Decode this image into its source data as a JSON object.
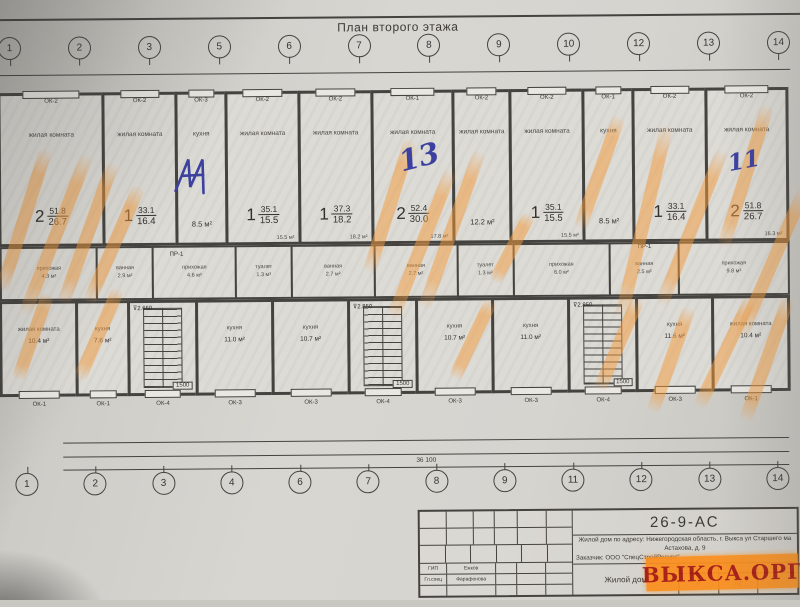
{
  "title": "План второго этажа",
  "watermark": "ВЫКСА.ОРГ",
  "colors": {
    "line": "#45433f",
    "wall": "#45433f",
    "highlight": "#f39a3a",
    "pen": "#3c41a0",
    "wm_bg": "#fb8f1d",
    "wm_text": "#a6160d"
  },
  "axes_top": [
    {
      "n": "1"
    },
    {
      "n": "2"
    },
    {
      "n": "3"
    },
    {
      "n": "5"
    },
    {
      "n": "6"
    },
    {
      "n": "7"
    },
    {
      "n": "8"
    },
    {
      "n": "9"
    },
    {
      "n": "10"
    },
    {
      "n": "12"
    },
    {
      "n": "13"
    },
    {
      "n": "14"
    }
  ],
  "axes_bottom": [
    {
      "n": "1"
    },
    {
      "n": "2"
    },
    {
      "n": "3"
    },
    {
      "n": "4"
    },
    {
      "n": "6"
    },
    {
      "n": "7"
    },
    {
      "n": "8"
    },
    {
      "n": "9"
    },
    {
      "n": "11"
    },
    {
      "n": "12"
    },
    {
      "n": "13"
    },
    {
      "n": "14"
    }
  ],
  "dims_top": [
    {
      "v": "400"
    },
    {
      "v": "2 100"
    },
    {
      "v": "1 250"
    },
    {
      "v": "2 100"
    },
    {
      "v": "1 500"
    },
    {
      "v": "1 200"
    },
    {
      "v": "1 750"
    },
    {
      "v": "2 100"
    },
    {
      "v": "1 050"
    },
    {
      "v": "2 100"
    },
    {
      "v": "1 625"
    },
    {
      "v": "1 500"
    },
    {
      "v": "1 625"
    },
    {
      "v": "2 100"
    },
    {
      "v": "1 050"
    },
    {
      "v": "2 100"
    },
    {
      "v": "750"
    },
    {
      "v": "1 200"
    },
    {
      "v": "1 500"
    },
    {
      "v": "2 100"
    },
    {
      "v": "1 250"
    },
    {
      "v": "2 100"
    },
    {
      "v": "400"
    }
  ],
  "dims_bottom1": [
    {
      "v": "765"
    },
    {
      "v": "1 500"
    },
    {
      "v": "1 800"
    },
    {
      "v": "1 200"
    },
    {
      "v": "2 000"
    },
    {
      "v": "1 000"
    },
    {
      "v": "2 000"
    },
    {
      "v": "1 200"
    },
    {
      "v": "2 760"
    },
    {
      "v": "1 200"
    },
    {
      "v": "2 000"
    },
    {
      "v": "1 000"
    },
    {
      "v": "2 000"
    },
    {
      "v": "1 200"
    },
    {
      "v": "2 760"
    },
    {
      "v": "1 200"
    },
    {
      "v": "2 000"
    },
    {
      "v": "1 000"
    },
    {
      "v": "2 000"
    },
    {
      "v": "1 200"
    },
    {
      "v": "1 800"
    },
    {
      "v": "1 500"
    },
    {
      "v": "765"
    }
  ],
  "dims_bottom2": [
    {
      "v": "3 250"
    },
    {
      "v": "3 200"
    },
    {
      "v": "2 680"
    },
    {
      "v": "3 680"
    },
    {
      "v": "3 600"
    },
    {
      "v": "2 880"
    },
    {
      "v": "3 600"
    },
    {
      "v": "3 680"
    },
    {
      "v": "2 880"
    },
    {
      "v": "3 200"
    },
    {
      "v": "3 250"
    }
  ],
  "dims_total": "36 100",
  "rooms_top": [
    {
      "window": "ОК-2",
      "label": "жилая комната",
      "num": "2",
      "a1": "51.8",
      "a2": "26.7"
    },
    {
      "window": "ОК-2",
      "label": "жилая комната",
      "num": "1",
      "a1": "33.1",
      "a2": "16.4"
    },
    {
      "window": "ОК-3",
      "label": "кухня",
      "note": "8.5 м²"
    },
    {
      "window": "ОК-2",
      "label": "жилая комната",
      "num": "1",
      "a1": "35.1",
      "a2": "15.5",
      "sub": "15.5 м²"
    },
    {
      "window": "ОК-2",
      "label": "жилая комната",
      "num": "1",
      "a1": "37.3",
      "a2": "18.2",
      "sub": "18.2 м²"
    },
    {
      "window": "ОК-1",
      "label": "жилая комната",
      "num": "2",
      "a1": "52.4",
      "a2": "30.0",
      "sub": "17.8 м²"
    },
    {
      "window": "ОК-2",
      "label": "жилая комната",
      "note": "12.2 м²"
    },
    {
      "window": "ОК-2",
      "label": "жилая комната",
      "num": "1",
      "a1": "35.1",
      "a2": "15.5",
      "sub": "15.5 м²"
    },
    {
      "window": "ОК-1",
      "label": "кухня",
      "note": "8.5 м²"
    },
    {
      "window": "ОК-2",
      "label": "жилая комната",
      "num": "1",
      "a1": "33.1",
      "a2": "16.4"
    },
    {
      "window": "ОК-2",
      "label": "жилая комната",
      "num": "2",
      "a1": "51.8",
      "a2": "26.7",
      "sub": "16.3 м²"
    }
  ],
  "service": [
    {
      "label": "прихожая",
      "area": "4.3 м²"
    },
    {
      "label": "ванная",
      "area": "2.9 м²"
    },
    {
      "label": "прихожая",
      "area": "4.6 м²"
    },
    {
      "label": "туалет",
      "area": "1.3 м²"
    },
    {
      "label": "ванная",
      "area": "2.7 м²"
    },
    {
      "label": "ванная",
      "area": "2.7 м²"
    },
    {
      "label": "туалет",
      "area": "1.3 м²"
    },
    {
      "label": "прихожая",
      "area": "6.0 м²"
    },
    {
      "label": "ванная",
      "area": "2.5 м²"
    },
    {
      "label": "прихожая",
      "area": "9.8 м²"
    }
  ],
  "rooms_bottom": [
    {
      "label": "жилая комната",
      "area": "10.4 м²",
      "window": "ОК-1"
    },
    {
      "label": "кухня",
      "area": "7.6 м²",
      "window": "ОК-1"
    },
    {
      "stairs": true,
      "window": "ОК-4",
      "elev_top": "⊽2.650",
      "elev_mid": "1500"
    },
    {
      "label": "кухня",
      "area": "11.0 м²",
      "window": "ОК-3"
    },
    {
      "label": "кухня",
      "area": "10.7 м²",
      "window": "ОК-3"
    },
    {
      "stairs": true,
      "window": "ОК-4",
      "elev_top": "⊽2.850",
      "elev_mid": "1500"
    },
    {
      "label": "кухня",
      "area": "10.7 м²",
      "window": "ОК-3"
    },
    {
      "label": "кухня",
      "area": "11.0 м²",
      "window": "ОК-3"
    },
    {
      "stairs": true,
      "window": "ОК-4",
      "elev_top": "⊽2.850",
      "elev_mid": "1500"
    },
    {
      "label": "кухня",
      "area": "11.6 м²",
      "window": "ОК-3"
    },
    {
      "label": "жилая комната",
      "area": "10.4 м²",
      "window": "ОК-1"
    }
  ],
  "labels": {
    "pr1": "ПР-1",
    "pen_13": "13",
    "pen_11": "11"
  },
  "notes": [
    {
      "t": "ПРИМЕЧАНИЕ"
    },
    {
      "t": "Разрез 1-1 см. л. 07-АС"
    },
    {
      "t": "Развертки вентканалов см. л. 39, 40, 41, 42, 43-АС"
    },
    {
      "t": "ПРИМЕЧАНИЕ (к кладочному плану второго этажа)"
    },
    {
      "t": "Кладку наружных и внутренних стен 1 этажа выполнять на ц/п растворе марки 100."
    },
    {
      "t": "Кладку внутренних стен в местах узловых, Т-образных и крестообразных пересечений, а также в местах"
    },
    {
      "t": "примыкания к наружным стенам армировать сетки 3Вр1-50/3Вр1-50 L=1.2м В=0.25м с шагом 400 мм по высоте кладки"
    },
    {
      "t": "Количество сеток на этаж 161 шт. Общая масса сеток на этаж 70 кг"
    },
    {
      "t": "Кладка лоджии производится из стеновых блоков БС-1, которые укладываются под прямым углом к стене здания"
    },
    {
      "t": "Взаимная перевязка кладки лоджии и кладки здания обеспечивается укладкой двух стальных прутов ф8 длиной 1200 мм"
    },
    {
      "t": "в каждом ряду блоков."
    }
  ],
  "stamp": {
    "doc_no": "26-9-АС",
    "address1": "Жилой дом по адресу: Нижегородская область, г. Выкса ул Старшего ма",
    "address2": "Астахова, д. 9",
    "client": "Заказчик: ООО \"СпецСтройРесурс\"",
    "object": "Жилой дом",
    "cols": [
      {
        "v": "Изм"
      },
      {
        "v": "Кол.уч"
      },
      {
        "v": "Лист"
      },
      {
        "v": "№док"
      },
      {
        "v": "Подп"
      },
      {
        "v": "Дата"
      }
    ],
    "rows": [
      {
        "role": "ГИП",
        "name": "Ежков"
      },
      {
        "role": "Гл.спец",
        "name": "Фарафонова"
      },
      {
        "role": "",
        "name": ""
      }
    ],
    "mini_heads": [
      {
        "v": "Стадия"
      },
      {
        "v": "Лист"
      },
      {
        "v": "Листов"
      }
    ],
    "stage": "Р",
    "sheet_no": "02",
    "sheets_total": ""
  }
}
